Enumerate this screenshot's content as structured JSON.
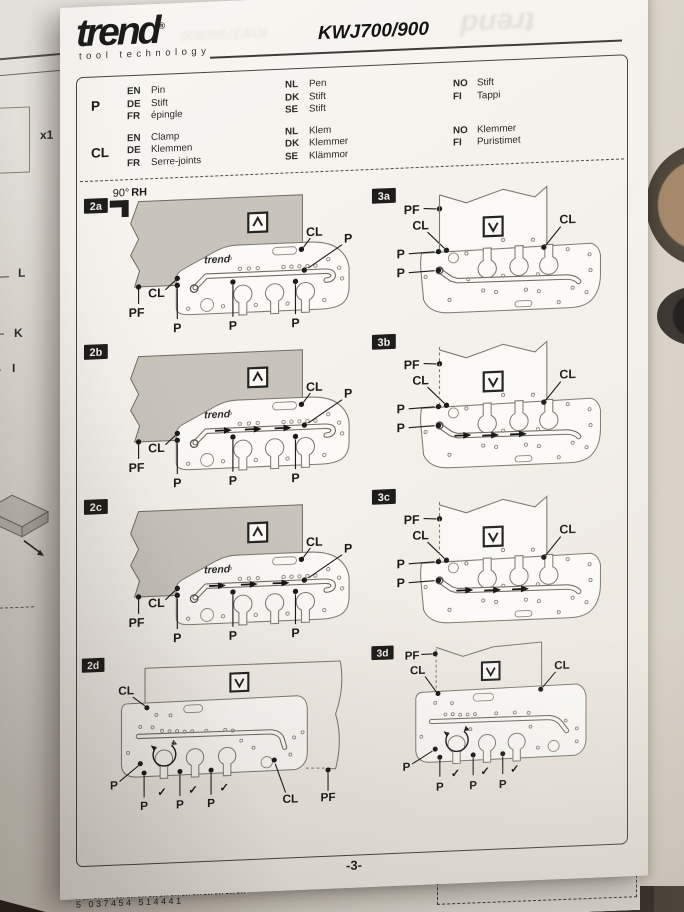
{
  "header": {
    "brand": "trend",
    "registered_mark": "®",
    "tagline": "tool technology",
    "model": "KWJ700/900"
  },
  "legend": {
    "rows": [
      {
        "key": "P",
        "entries": [
          {
            "code": "EN",
            "value": "Pin"
          },
          {
            "code": "DE",
            "value": "Stift"
          },
          {
            "code": "FR",
            "value": "épingle"
          },
          {
            "code": "NL",
            "value": "Pen"
          },
          {
            "code": "DK",
            "value": "Stift"
          },
          {
            "code": "SE",
            "value": "Stift"
          },
          {
            "code": "NO",
            "value": "Stift"
          },
          {
            "code": "FI",
            "value": "Tappi"
          }
        ]
      },
      {
        "key": "CL",
        "entries": [
          {
            "code": "EN",
            "value": "Clamp"
          },
          {
            "code": "DE",
            "value": "Klemmen"
          },
          {
            "code": "FR",
            "value": "Serre-joints"
          },
          {
            "code": "NL",
            "value": "Klem"
          },
          {
            "code": "DK",
            "value": "Klemmer"
          },
          {
            "code": "SE",
            "value": "Klämmor"
          },
          {
            "code": "NO",
            "value": "Klemmer"
          },
          {
            "code": "FI",
            "value": "Puristimet"
          }
        ]
      }
    ]
  },
  "angle_note": {
    "angle": "90°",
    "hand": "RH"
  },
  "labels": {
    "pin": "P",
    "clamp": "CL",
    "pin_fence": "PF",
    "check": "✓",
    "jig_brand": "trend"
  },
  "panel_ids": {
    "p2a": "2a",
    "p2b": "2b",
    "p2c": "2c",
    "p2d": "2d",
    "p3a": "3a",
    "p3b": "3b",
    "p3c": "3c",
    "p3d": "3d"
  },
  "footer": {
    "page_number": "-3-"
  },
  "background_page": {
    "quantity": "x1",
    "callout_l": "L",
    "callout_k": "K",
    "callout_i": "I",
    "barcode_digits": "5 037454 514441"
  }
}
